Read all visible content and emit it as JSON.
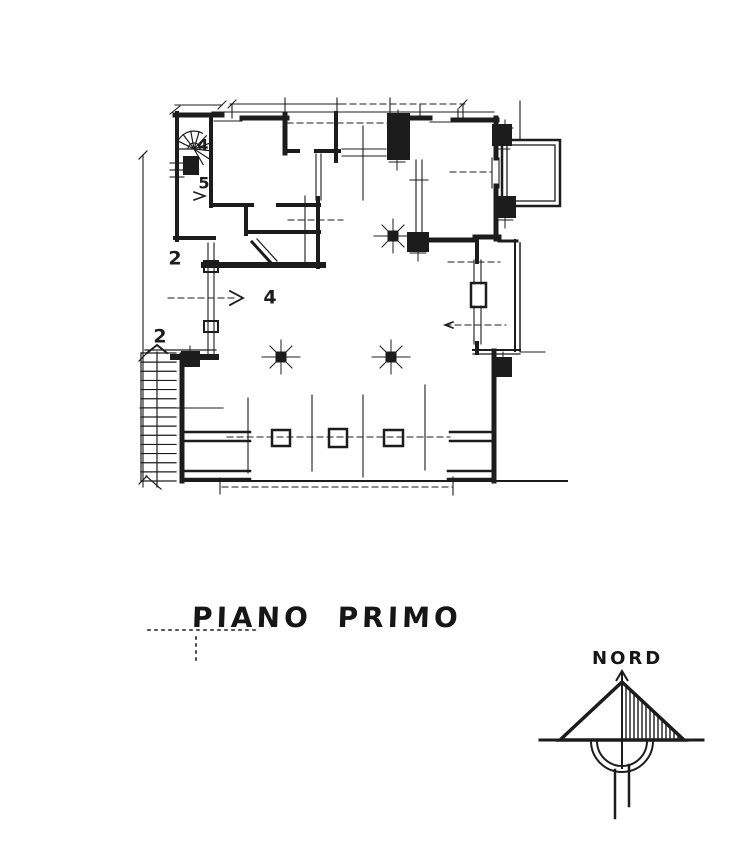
{
  "page": {
    "background": "#ffffff",
    "ink": "#1c1c1c"
  },
  "title": {
    "label": "PIANO PRIMO"
  },
  "north": {
    "label": "NORD",
    "apex": [
      622,
      682
    ],
    "base_left": [
      560,
      740
    ],
    "base_right": [
      684,
      740
    ],
    "baseline": [
      540,
      740,
      703,
      740
    ],
    "needle": [
      622,
      672,
      622,
      768
    ],
    "arcs": {
      "cx": 622,
      "cy": 741,
      "r1": 25,
      "r2": 31
    },
    "tails": [
      [
        615,
        770,
        615,
        818,
        2.5
      ],
      [
        629,
        765,
        629,
        806,
        2.5
      ]
    ],
    "hatch_step": 4
  },
  "plan": {
    "labels": [
      {
        "t": "4",
        "x": 203,
        "y": 146,
        "fs": 16
      },
      {
        "t": "5",
        "x": 204,
        "y": 184,
        "fs": 16
      },
      {
        "t": "2",
        "x": 175,
        "y": 259,
        "fs": 19
      },
      {
        "t": "2",
        "x": 160,
        "y": 337,
        "fs": 19
      },
      {
        "t": "4",
        "x": 270,
        "y": 298,
        "fs": 19
      }
    ],
    "walls": [
      [
        175,
        115,
        222,
        115,
        5
      ],
      [
        177,
        113,
        177,
        240,
        4
      ],
      [
        242,
        118,
        287,
        118,
        5
      ],
      [
        285,
        115,
        285,
        153,
        5
      ],
      [
        285,
        151,
        298,
        151,
        4
      ],
      [
        316,
        151,
        339,
        151,
        4
      ],
      [
        336,
        113,
        336,
        161,
        4
      ],
      [
        407,
        118,
        430,
        118,
        5
      ],
      [
        453,
        120,
        497,
        120,
        5
      ],
      [
        496,
        118,
        496,
        158,
        5
      ],
      [
        496,
        186,
        496,
        239,
        5
      ],
      [
        475,
        237,
        499,
        237,
        5
      ],
      [
        477,
        237,
        477,
        262,
        4
      ],
      [
        477,
        343,
        477,
        353,
        4
      ],
      [
        494,
        351,
        494,
        481,
        5
      ],
      [
        182,
        355,
        182,
        481,
        5
      ],
      [
        173,
        357,
        216,
        357,
        6
      ],
      [
        211,
        115,
        211,
        206,
        4
      ],
      [
        214,
        205,
        252,
        205,
        4
      ],
      [
        278,
        205,
        319,
        205,
        4
      ],
      [
        246,
        205,
        246,
        234,
        4
      ],
      [
        246,
        232,
        319,
        232,
        4
      ],
      [
        318,
        198,
        318,
        267,
        4
      ],
      [
        204,
        265,
        323,
        265,
        6
      ],
      [
        175,
        238,
        214,
        238,
        4
      ],
      [
        417,
        240,
        474,
        240,
        5
      ],
      [
        499,
        241,
        517,
        241,
        3
      ]
    ],
    "medium_lines": [
      [
        450,
        432,
        494,
        432,
        2.5
      ],
      [
        450,
        441,
        494,
        441,
        2.5
      ],
      [
        448,
        471,
        494,
        471,
        2.5
      ],
      [
        448,
        479,
        494,
        479,
        2.5
      ],
      [
        183,
        432,
        250,
        432,
        2.5
      ],
      [
        183,
        441,
        250,
        441,
        2.5
      ],
      [
        183,
        471,
        250,
        471,
        2.5
      ],
      [
        183,
        479,
        250,
        479,
        2.5
      ],
      [
        183,
        481,
        567,
        481,
        2
      ],
      [
        515,
        240,
        515,
        351,
        2
      ],
      [
        520,
        243,
        520,
        351,
        1.5
      ],
      [
        473,
        350,
        520,
        350,
        2
      ],
      [
        473,
        354,
        520,
        354,
        1.2
      ],
      [
        145,
        350,
        216,
        350,
        1.2
      ]
    ],
    "thin_lines": [
      [
        212,
        112,
        494,
        112
      ],
      [
        214,
        121,
        242,
        121
      ],
      [
        342,
        149,
        386,
        149
      ],
      [
        342,
        156,
        386,
        156
      ],
      [
        430,
        122,
        453,
        122
      ],
      [
        492,
        158,
        492,
        188
      ],
      [
        499,
        158,
        499,
        188
      ],
      [
        474,
        260,
        474,
        284
      ],
      [
        481,
        260,
        481,
        284
      ],
      [
        474,
        306,
        474,
        344
      ],
      [
        481,
        306,
        481,
        344
      ],
      [
        316,
        154,
        316,
        200
      ],
      [
        321,
        154,
        321,
        200
      ],
      [
        416,
        160,
        416,
        236
      ],
      [
        422,
        160,
        422,
        236
      ],
      [
        208,
        243,
        208,
        354
      ],
      [
        214,
        243,
        214,
        354
      ],
      [
        305,
        196,
        305,
        262
      ],
      [
        363,
        126,
        363,
        200
      ],
      [
        363,
        395,
        363,
        477
      ],
      [
        248,
        398,
        248,
        473
      ],
      [
        312,
        395,
        312,
        471
      ],
      [
        425,
        385,
        425,
        470
      ],
      [
        140,
        408,
        223,
        408
      ],
      [
        143,
        155,
        143,
        487
      ],
      [
        230,
        104,
        340,
        104
      ],
      [
        175,
        105,
        222,
        105
      ],
      [
        520,
        101,
        520,
        139
      ],
      [
        520,
        352,
        545,
        352
      ],
      [
        410,
        180,
        428,
        180
      ],
      [
        170,
        163,
        184,
        163
      ],
      [
        170,
        170,
        184,
        170
      ],
      [
        170,
        177,
        184,
        177
      ],
      [
        232,
        104,
        232,
        118
      ],
      [
        285,
        98,
        285,
        118
      ],
      [
        337,
        98,
        337,
        113
      ],
      [
        390,
        98,
        390,
        113
      ],
      [
        420,
        104,
        420,
        118
      ],
      [
        463,
        104,
        463,
        121
      ],
      [
        220,
        478,
        220,
        494
      ],
      [
        453,
        477,
        453,
        495
      ],
      [
        458,
        109,
        458,
        118
      ]
    ],
    "dashed_lines": [
      [
        168,
        298,
        236,
        298
      ],
      [
        450,
        172,
        492,
        172
      ],
      [
        288,
        220,
        343,
        220
      ],
      [
        448,
        262,
        500,
        262
      ],
      [
        445,
        325,
        506,
        325
      ],
      [
        227,
        437,
        450,
        437
      ],
      [
        222,
        487,
        453,
        487
      ],
      [
        287,
        123,
        388,
        123
      ],
      [
        340,
        104,
        465,
        104
      ]
    ],
    "dotted_lines": [
      [
        148,
        630,
        256,
        630
      ],
      [
        196,
        637,
        196,
        661
      ]
    ],
    "filled_rects": [
      [
        183,
        156,
        16,
        19
      ],
      [
        387,
        113,
        23,
        47
      ],
      [
        492,
        124,
        20,
        22
      ],
      [
        496,
        196,
        20,
        22
      ],
      [
        496,
        357,
        16,
        20
      ],
      [
        181,
        351,
        19,
        16
      ],
      [
        407,
        232,
        22,
        20
      ]
    ],
    "hollow_rects": [
      [
        272,
        430,
        18,
        16,
        2.5
      ],
      [
        329,
        429,
        18,
        18,
        2.5
      ],
      [
        384,
        430,
        19,
        16,
        2.5
      ],
      [
        471,
        283,
        15,
        24,
        2.5
      ],
      [
        204,
        261,
        14,
        11,
        2
      ],
      [
        204,
        321,
        14,
        11,
        2
      ],
      [
        502,
        140,
        58,
        66,
        2.5
      ],
      [
        507,
        145,
        48,
        56,
        1.3
      ]
    ],
    "columns": [
      {
        "x": 393,
        "y": 236
      },
      {
        "x": 281,
        "y": 357
      },
      {
        "x": 391,
        "y": 357
      }
    ],
    "crosses": [
      {
        "x": 397,
        "y": 162
      },
      {
        "x": 502,
        "y": 149
      },
      {
        "x": 505,
        "y": 220
      },
      {
        "x": 503,
        "y": 360
      },
      {
        "x": 418,
        "y": 253
      },
      {
        "x": 190,
        "y": 354
      },
      {
        "x": 398,
        "y": 118
      },
      {
        "x": 505,
        "y": 128
      }
    ],
    "arrows": [
      {
        "pts": [
          [
            230,
            291
          ],
          [
            243,
            298
          ],
          [
            230,
            305
          ]
        ],
        "w": 1.8
      },
      {
        "pts": [
          [
            194,
            192
          ],
          [
            205,
            196
          ],
          [
            194,
            200
          ]
        ],
        "w": 1.5
      },
      {
        "pts": [
          [
            147,
            353
          ],
          [
            157,
            345
          ],
          [
            167,
            353
          ]
        ],
        "w": 2
      },
      {
        "pts": [
          [
            453,
            322
          ],
          [
            445,
            325
          ],
          [
            453,
            328
          ]
        ],
        "w": 1.5
      }
    ],
    "diagonals": [
      [
        252,
        242,
        272,
        264,
        3
      ],
      [
        257,
        239,
        277,
        261,
        1.2
      ],
      [
        146,
        476,
        161,
        489,
        1.2
      ],
      [
        139,
        159,
        147,
        151,
        1.2
      ],
      [
        139,
        361,
        147,
        353,
        1.2
      ],
      [
        139,
        484,
        147,
        476,
        1.2
      ],
      [
        228,
        108,
        236,
        100,
        1
      ],
      [
        459,
        108,
        467,
        100,
        1
      ],
      [
        170,
        114,
        180,
        106,
        1
      ],
      [
        218,
        109,
        226,
        101,
        1
      ]
    ],
    "stair": {
      "x": 141,
      "w": 35,
      "y0": 353,
      "y1": 481,
      "n": 15,
      "rail_x": 157
    },
    "spiral": {
      "cx": 194,
      "cy": 149,
      "r": 18,
      "spokes": 9
    }
  }
}
